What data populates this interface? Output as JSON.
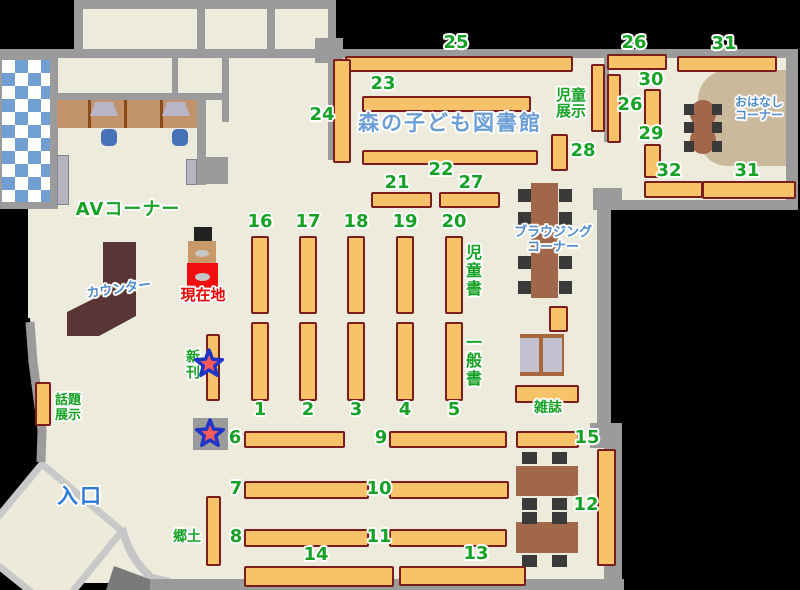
{
  "title": "森の子ども図書館",
  "labels": {
    "av_corner": "AVコーナー",
    "counter": "カウンター",
    "current_location": "現在地",
    "new_books": "新刊",
    "topic_line1": "話題",
    "topic_line2": "展示",
    "entrance": "入口",
    "local_history": "郷土",
    "magazines": "雑誌",
    "children_books": "児童書",
    "general_books": "一般書",
    "browsing_line1": "ブラウジング",
    "browsing_line2": "コーナー",
    "children_display_line1": "児童",
    "children_display_line2": "展示",
    "story_line1": "おはなし",
    "story_line2": "コーナー"
  },
  "num": {
    "1": "1",
    "2": "2",
    "3": "3",
    "4": "4",
    "5": "5",
    "6": "6",
    "7": "7",
    "8": "8",
    "9": "9",
    "10": "10",
    "11": "11",
    "12": "12",
    "13": "13",
    "14": "14",
    "15": "15",
    "16": "16",
    "17": "17",
    "18": "18",
    "19": "19",
    "20": "20",
    "21": "21",
    "22": "22",
    "23": "23",
    "24": "24",
    "25": "25",
    "26": "26",
    "27": "27",
    "28": "28",
    "29": "29",
    "30": "30",
    "31": "31",
    "32": "32"
  },
  "colors": {
    "floor": "#edebdc",
    "wall": "#9b9b9b",
    "shelf_fill": "#f8c269",
    "shelf_border": "#7b1d1d",
    "label_green": "#17a226",
    "label_blue": "#4f8ccd",
    "entrance_blue": "#2f79da",
    "title_blue": "#6b9fd6",
    "current_red": "#e80000",
    "counter_brown": "#5a3535",
    "table_brown": "#a0674a",
    "desk_tan": "#c2936b",
    "story_floor_tan": "#cbb99c",
    "checker_blue": "#6f9fd3",
    "star_fill": "#ff5a5a",
    "star_outline": "#1f35c8"
  }
}
